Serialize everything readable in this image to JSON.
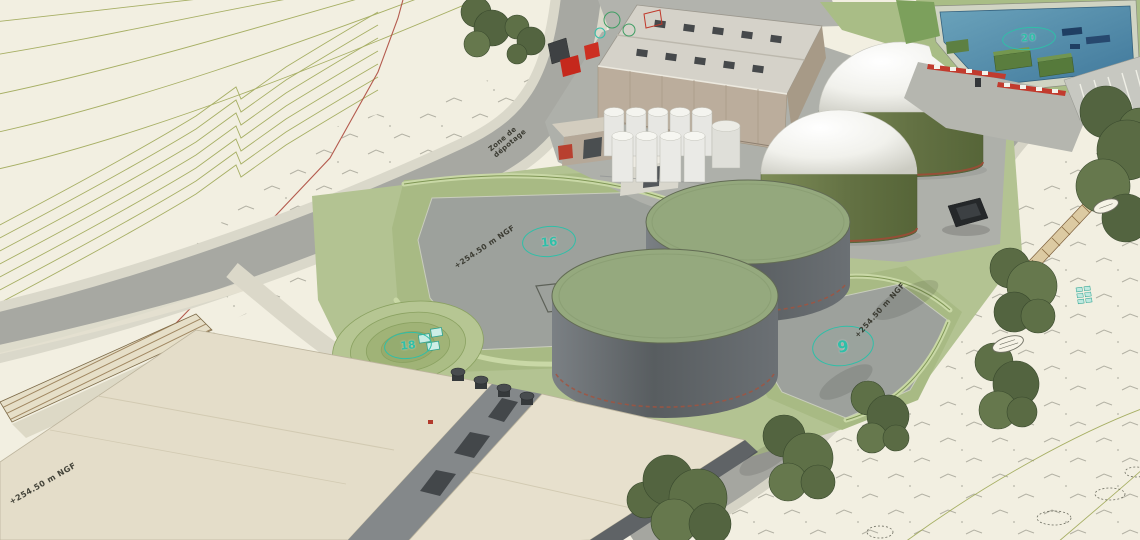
{
  "markers": {
    "pond": "20",
    "platform": "16",
    "mound": "18",
    "tank_yard": "9"
  },
  "labels": {
    "elevation_platform": "+254.50 m NGF",
    "elevation_tank_yard": "+254.50 m NGF",
    "elevation_road": "+254.50 m NGF",
    "unloading_line1": "Zone de",
    "unloading_line2": "dépotage"
  },
  "colors": {
    "terrain": "#f2efe1",
    "contour_olive": "#9aa44f",
    "road_gray": "#a7a8a2",
    "pad_gray": "#9da19c",
    "berm_green": "#a8ba84",
    "mound_green": "#97ab6c",
    "tank_wall_gray": "#585d60",
    "tank_top_green": "#94a87d",
    "digester_base_olive": "#647244",
    "dome_white": "#f4f4ef",
    "building_wall_tan": "#bbad9c",
    "roof_beige": "#e4ddc9",
    "pond_blue": "#40789b",
    "marker_teal": "#2fbfa8",
    "truck_red": "#c5281c",
    "boundary_red": "#ad4a3e"
  }
}
